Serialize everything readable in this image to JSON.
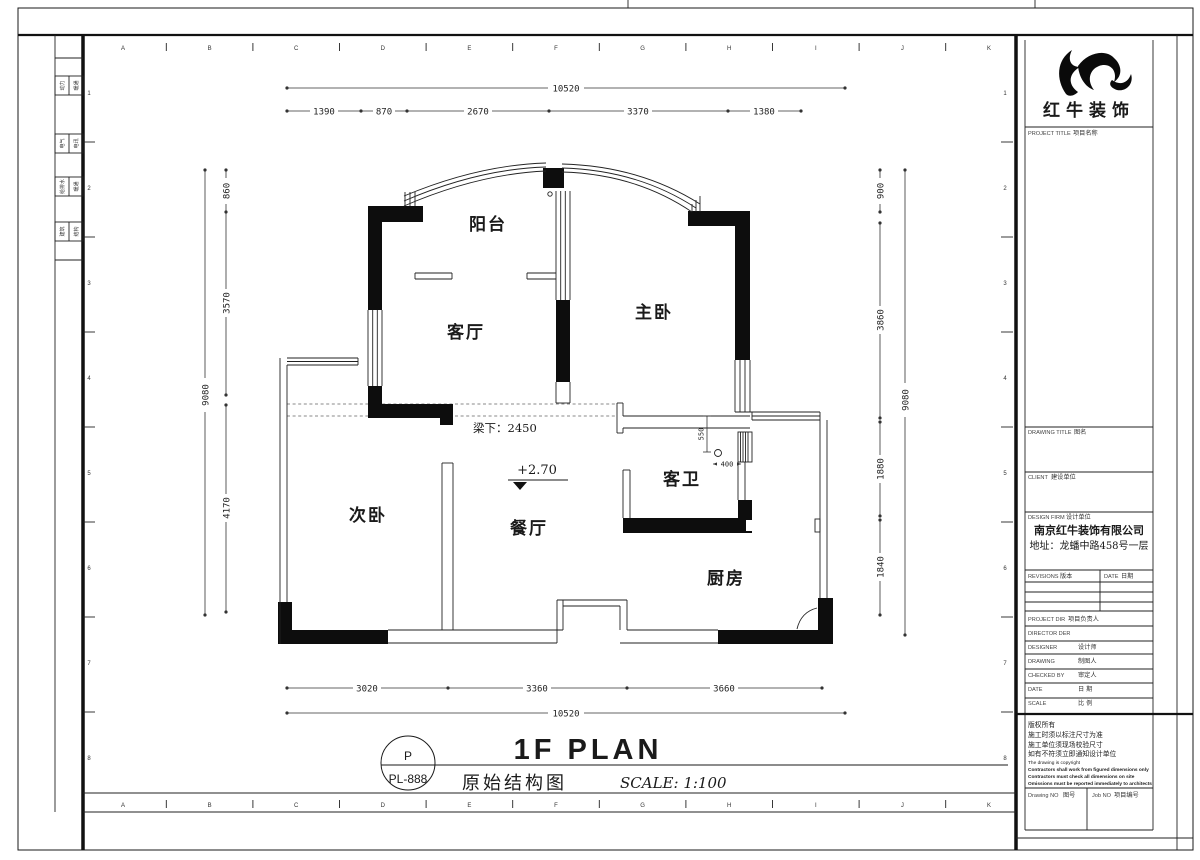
{
  "logo": {
    "name": "红牛装饰"
  },
  "title_block": {
    "project_title_en": "PROJECT TITLE",
    "project_title_cn": "项目名称",
    "drawing_title_en": "DRAWING TITLE",
    "drawing_title_cn": "图名",
    "client_en": "CLIENT",
    "client_cn": "建设单位",
    "design_firm_en": "DESIGN FIRM",
    "design_firm_cn": "设计单位",
    "firm_name": "南京红牛装饰有限公司",
    "firm_address": "地址：龙蟠中路458号一层",
    "revisions_en": "REVISIONS",
    "revisions_cn": "版本",
    "rev_date_en": "DATE",
    "rev_date_cn": "日期",
    "project_dir_en": "PROJECT DIR",
    "project_dir_cn": "项目负责人",
    "director_en": "DIRECTOR DER",
    "designer_en": "DESIGNER",
    "designer_cn": "设计师",
    "drawing_by_en": "DRAWING",
    "drawing_by_cn": "制图人",
    "checked_en": "CHECKED BY",
    "checked_cn": "审定人",
    "date_en": "DATE",
    "date_cn": "日 期",
    "scale_en": "SCALE",
    "scale_cn": "比 例",
    "notes_cn": [
      "版权所有",
      "施工时须以标注尺寸为准",
      "施工单位须现场校验尺寸",
      "如有不符须立即通知设计单位"
    ],
    "notes_en": [
      "The drawing is copyright",
      "Contractors shall work from figured dimensions only",
      "Contractors must check all dimensions on site",
      "Omissions must be reported immediately to architects"
    ],
    "drawing_no_en": "Drawing NO",
    "drawing_no_cn": "图号",
    "job_no_en": "Job NO",
    "job_no_cn": "项目编号"
  },
  "margin": {
    "grid_letters": [
      "A",
      "B",
      "C",
      "D",
      "E",
      "F",
      "G",
      "H",
      "I",
      "J",
      "K"
    ],
    "grid_numbers": [
      "1",
      "2",
      "3",
      "4",
      "5",
      "6",
      "7",
      "8"
    ],
    "disciplines": [
      [
        "动力",
        "暖通"
      ],
      [
        "电气",
        "电讯"
      ],
      [
        "给排水",
        "暖通"
      ],
      [
        "建筑",
        "结构"
      ]
    ]
  },
  "plan": {
    "rooms": {
      "balcony": "阳台",
      "living": "客厅",
      "master": "主卧",
      "second": "次卧",
      "dining": "餐厅",
      "bath": "客卫",
      "kitchen": "厨房"
    },
    "beam_note": "梁下：2450",
    "level_note": "+2.70",
    "dims": {
      "top_total": "10520",
      "top_chain": [
        "1390",
        "870",
        "2670",
        "3370",
        "1380"
      ],
      "bottom_chain": [
        "3020",
        "3360",
        "3660"
      ],
      "bottom_total": "10520",
      "left_total": "9080",
      "left_chain": [
        "860",
        "3570",
        "4170"
      ],
      "right_total": "9080",
      "right_chain": [
        "900",
        "3860",
        "1880",
        "1840"
      ],
      "bath_h": "550",
      "bath_w": "400"
    }
  },
  "footer": {
    "key_letter": "P",
    "sheet_no": "PL-888",
    "title_en": "1F PLAN",
    "title_cn": "原始结构图",
    "scale": "SCALE: 1:100"
  }
}
